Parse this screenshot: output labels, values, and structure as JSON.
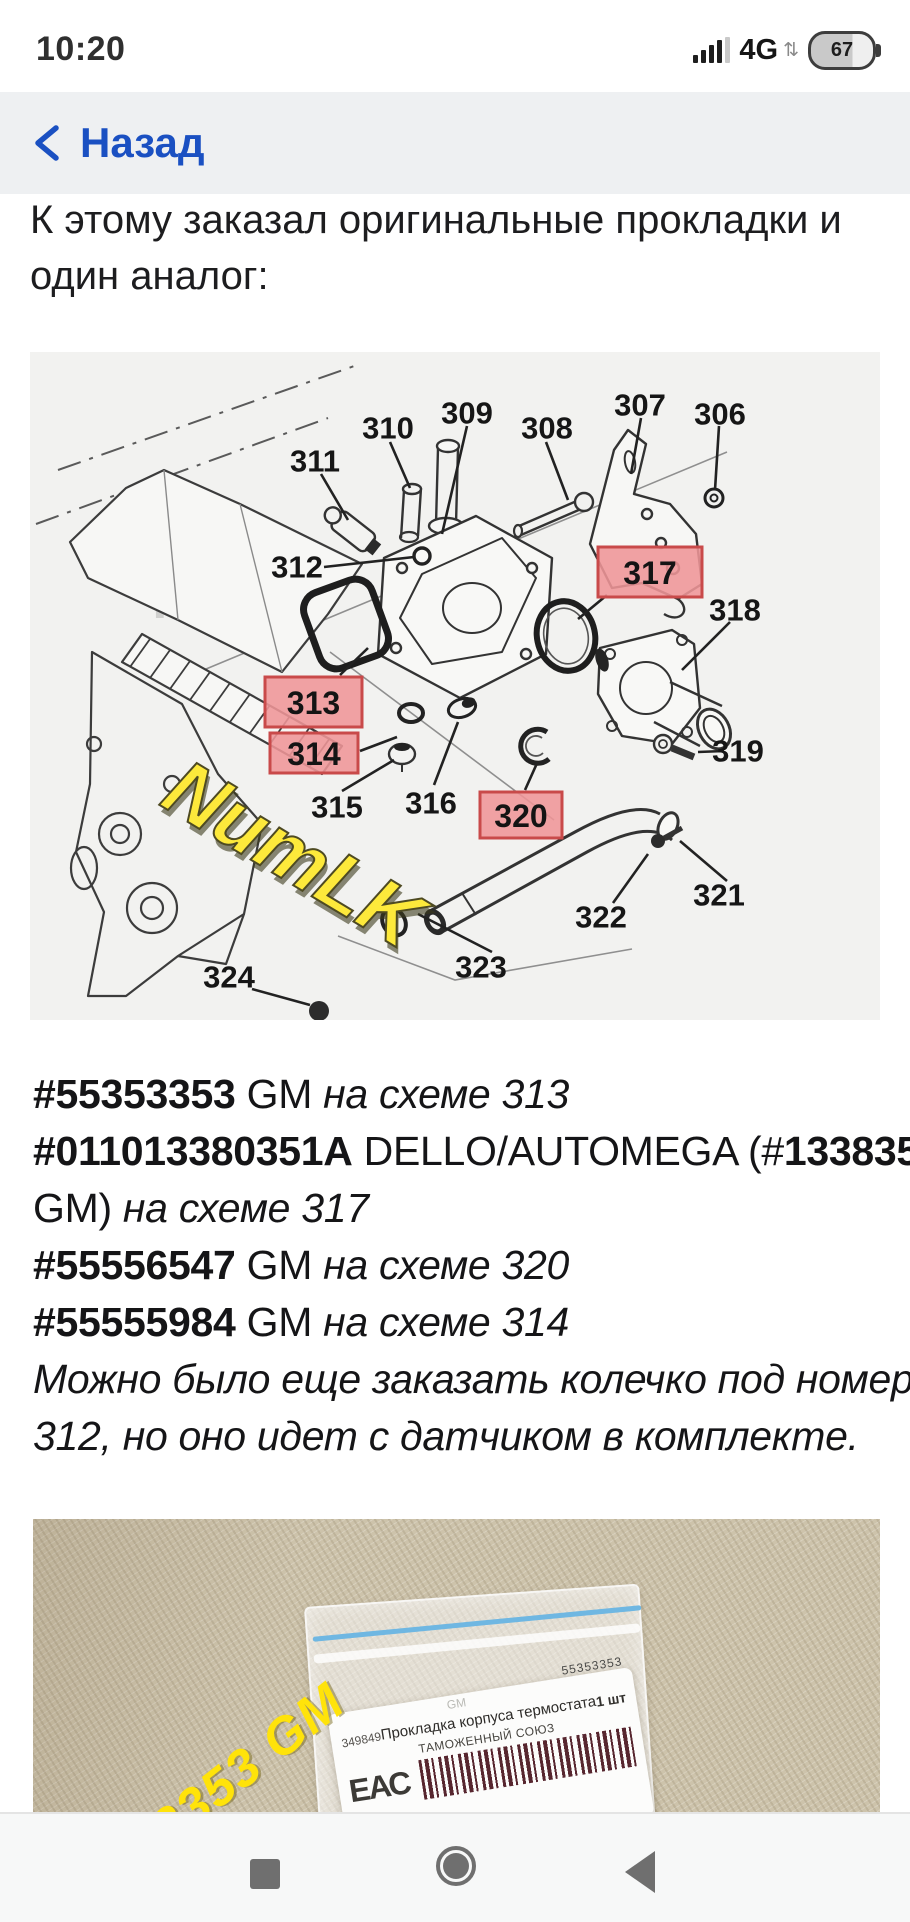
{
  "status_bar": {
    "time": "10:20",
    "network": "4G",
    "battery_percent": "67"
  },
  "back_bar": {
    "back_label": "Назад"
  },
  "intro": {
    "line1": "К этому заказал оригинальные прокладки и",
    "line2": "один аналог:"
  },
  "diagram": {
    "watermark_gray": "klad",
    "watermark_yellow": "NumLK",
    "highlight_fill": "#ef9597",
    "highlight_border": "#c94a4a",
    "callouts": [
      {
        "text": "306",
        "x": 690,
        "y": 62
      },
      {
        "text": "307",
        "x": 610,
        "y": 53
      },
      {
        "text": "308",
        "x": 517,
        "y": 76
      },
      {
        "text": "309",
        "x": 437,
        "y": 61
      },
      {
        "text": "310",
        "x": 358,
        "y": 76
      },
      {
        "text": "311",
        "x": 285,
        "y": 109
      },
      {
        "text": "312",
        "x": 267,
        "y": 215
      },
      {
        "text": "315",
        "x": 307,
        "y": 455
      },
      {
        "text": "316",
        "x": 401,
        "y": 451
      },
      {
        "text": "318",
        "x": 705,
        "y": 258
      },
      {
        "text": "319",
        "x": 708,
        "y": 399
      },
      {
        "text": "321",
        "x": 689,
        "y": 543
      },
      {
        "text": "322",
        "x": 571,
        "y": 565
      },
      {
        "text": "323",
        "x": 451,
        "y": 615
      },
      {
        "text": "324",
        "x": 199,
        "y": 625
      }
    ],
    "highlights": [
      {
        "text": "313",
        "x": 235,
        "y": 325,
        "w": 97,
        "h": 50
      },
      {
        "text": "314",
        "x": 240,
        "y": 381,
        "w": 88,
        "h": 40
      },
      {
        "text": "317",
        "x": 568,
        "y": 195,
        "w": 104,
        "h": 50
      },
      {
        "text": "320",
        "x": 450,
        "y": 440,
        "w": 82,
        "h": 46
      }
    ]
  },
  "parts_text": {
    "lines": [
      [
        {
          "t": "#55353353",
          "s": "b"
        },
        {
          "t": " GM ",
          "s": "r"
        },
        {
          "t": "на схеме 313",
          "s": "i"
        }
      ],
      [
        {
          "t": "#011013380351A",
          "s": "b"
        },
        {
          "t": " DELLO/AUTOMEGA (#",
          "s": "r"
        },
        {
          "t": "1338351",
          "s": "b"
        }
      ],
      [
        {
          "t": "GM) ",
          "s": "r"
        },
        {
          "t": "на схеме 317",
          "s": "i"
        }
      ],
      [
        {
          "t": "#55556547",
          "s": "b"
        },
        {
          "t": " GM ",
          "s": "r"
        },
        {
          "t": "на схеме 320",
          "s": "i"
        }
      ],
      [
        {
          "t": "#55555984",
          "s": "b"
        },
        {
          "t": " GM ",
          "s": "r"
        },
        {
          "t": "на схеме 314",
          "s": "i"
        }
      ],
      [
        {
          "t": "Можно было еще заказать колечко под номером",
          "s": "i"
        }
      ],
      [
        {
          "t": "312, но оно идет с датчиком в комплекте.",
          "s": "i"
        }
      ]
    ]
  },
  "photo": {
    "watermark": "55353353 GM",
    "label": {
      "brand": "GM",
      "code_top": "55353353",
      "sku": "349849",
      "product": "Прокладка корпуса термостата",
      "qty": "1 шт",
      "customs": "ТАМОЖЕННЫЙ СОЮЗ",
      "eac": "ЕАС"
    }
  }
}
